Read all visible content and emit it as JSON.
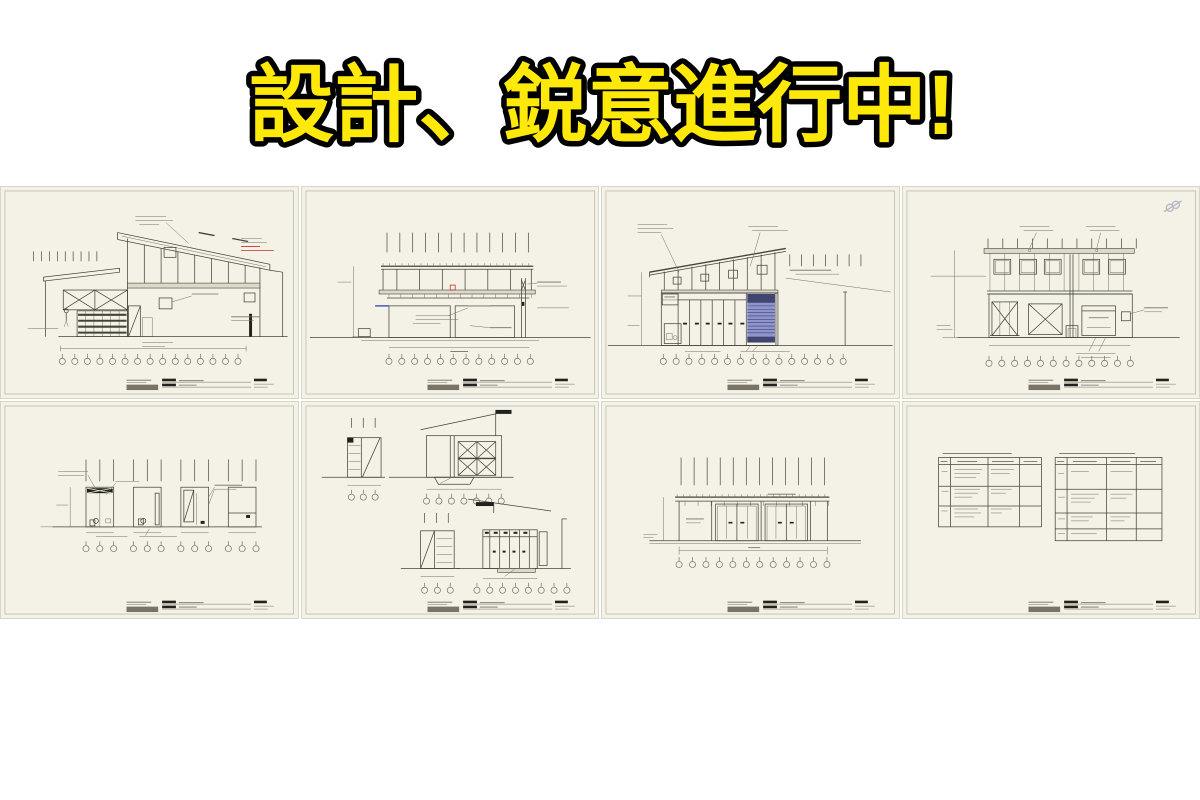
{
  "banner": {
    "headline": "設計、鋭意進行中!"
  },
  "colors": {
    "page": "#ffffff",
    "sheet": "#f4f2e6",
    "sheetline": "#d8d6c8",
    "frame": "#bdbbac",
    "ink": "#45443c",
    "ink2": "#716f62",
    "dark": "#22211d",
    "tbfill": "#787468",
    "band": "#dcd9c9",
    "red": "#c23429",
    "blue-slat": "#8d95cc",
    "blue-dark": "#3f4470",
    "blue-line": "#5761bb",
    "yellow": "#ffe90b",
    "yellow-stroke": "#000000",
    "watermark": "#b9b9c6"
  },
  "sheets": [
    {
      "name": "cross-section-shed-roof"
    },
    {
      "name": "cross-section-flat-deck"
    },
    {
      "name": "elevation-south-with-shutter"
    },
    {
      "name": "elevation-north-windows"
    },
    {
      "name": "toilet-detail-sections"
    },
    {
      "name": "partial-sections-lockers"
    },
    {
      "name": "elevation-sliding-doors"
    },
    {
      "name": "finish-schedule-tables"
    }
  ]
}
